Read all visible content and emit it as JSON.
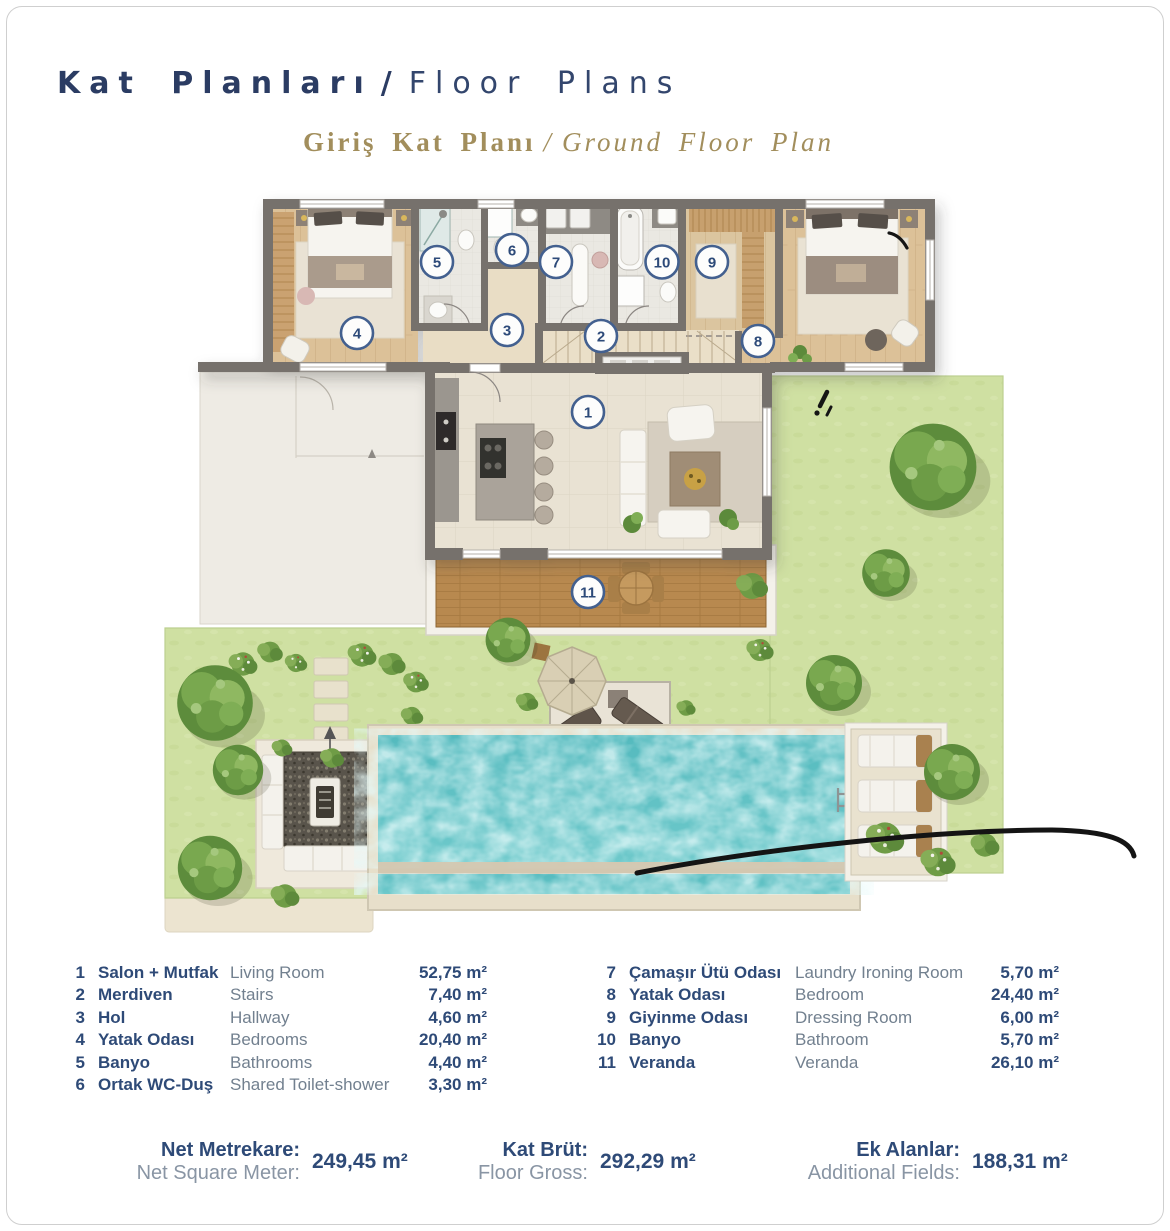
{
  "page": {
    "title": {
      "tr": "Kat Planları",
      "sep": "/",
      "en": "Floor Plans"
    },
    "subtitle": {
      "tr": "Giriş Kat Planı",
      "sep": "/",
      "en": "Ground Floor Plan"
    }
  },
  "plan": {
    "badges": [
      "1",
      "2",
      "3",
      "4",
      "5",
      "6",
      "7",
      "8",
      "9",
      "10",
      "11"
    ],
    "annotations": [
      "exclamation-pen-mark",
      "short-curve-pen-mark",
      "long-curve-pen-mark"
    ]
  },
  "legend": {
    "left": [
      {
        "no": "1",
        "tr": "Salon + Mutfak",
        "en": "Living Room",
        "area": "52,75 m²"
      },
      {
        "no": "2",
        "tr": "Merdiven",
        "en": "Stairs",
        "area": "7,40 m²"
      },
      {
        "no": "3",
        "tr": "Hol",
        "en": "Hallway",
        "area": "4,60 m²"
      },
      {
        "no": "4",
        "tr": "Yatak Odası",
        "en": "Bedrooms",
        "area": "20,40 m²"
      },
      {
        "no": "5",
        "tr": "Banyo",
        "en": "Bathrooms",
        "area": "4,40 m²"
      },
      {
        "no": "6",
        "tr": "Ortak WC-Duş",
        "en": "Shared Toilet-shower",
        "area": "3,30 m²"
      }
    ],
    "right": [
      {
        "no": "7",
        "tr": "Çamaşır Ütü Odası",
        "en": "Laundry Ironing Room",
        "area": "5,70 m²"
      },
      {
        "no": "8",
        "tr": "Yatak Odası",
        "en": "Bedroom",
        "area": "24,40 m²"
      },
      {
        "no": "9",
        "tr": "Giyinme Odası",
        "en": "Dressing Room",
        "area": "6,00 m²"
      },
      {
        "no": "10",
        "tr": "Banyo",
        "en": "Bathroom",
        "area": "5,70 m²"
      },
      {
        "no": "11",
        "tr": "Veranda",
        "en": "Veranda",
        "area": "26,10 m²"
      }
    ]
  },
  "stats": [
    {
      "tr": "Net Metrekare:",
      "en": "Net Square Meter:",
      "value": "249,45 m²"
    },
    {
      "tr": "Kat Brüt:",
      "en": "Floor Gross:",
      "value": "292,29 m²"
    },
    {
      "tr": "Ek Alanlar:",
      "en": "Additional Fields:",
      "value": "188,31 m²"
    }
  ],
  "colors": {
    "navy": "#2e4a77",
    "gold": "#a28e5c",
    "muted_gray": "#72808f",
    "wall_gray": "#76716c",
    "lawn_green": "#cfe0a2",
    "pool_turquoise": "#5abfc2",
    "deck_wood": "#b8894f",
    "room_wood": "#dcc198",
    "badge_ring": "#43608f"
  }
}
